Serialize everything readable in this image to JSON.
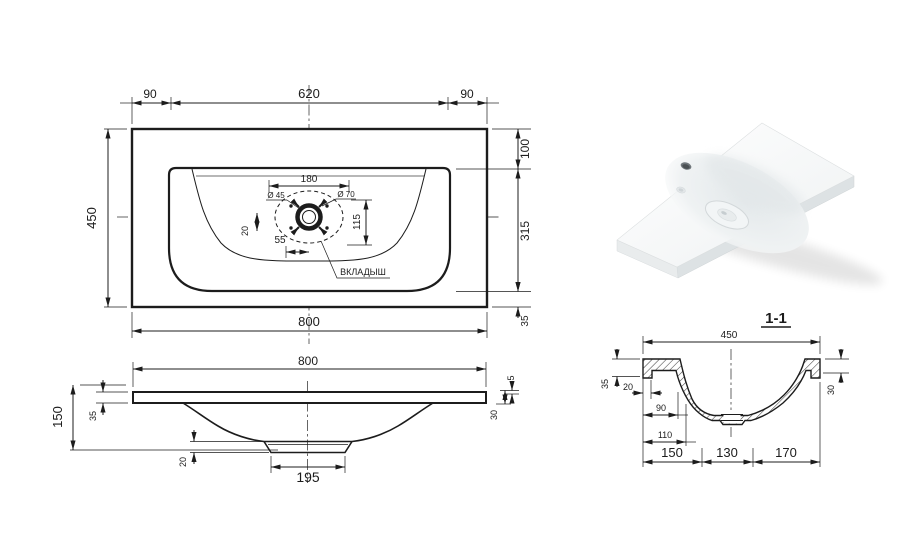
{
  "colors": {
    "line": "#1c1c1c",
    "centerline": "#555555",
    "background": "#ffffff",
    "hatch": "#444444"
  },
  "tv": {
    "d90l": "90",
    "d620": "620",
    "d90r": "90",
    "d450": "450",
    "d100": "100",
    "d315": "315",
    "d35": "35",
    "d800": "800",
    "d180": "180",
    "dia45": "Ø 45",
    "dia70": "Ø 70",
    "d115": "115",
    "d20": "20",
    "d55": "55",
    "insert": "ВКЛАДЫШ"
  },
  "fv": {
    "d800": "800",
    "d150": "150",
    "d35": "35",
    "d5": "5",
    "d30": "30",
    "d20": "20",
    "d195": "195"
  },
  "sv": {
    "title": "1-1",
    "d450": "450",
    "d35": "35",
    "d20": "20",
    "d90": "90",
    "d110": "110",
    "d150": "150",
    "d130": "130",
    "d170": "170",
    "d30": "30"
  }
}
